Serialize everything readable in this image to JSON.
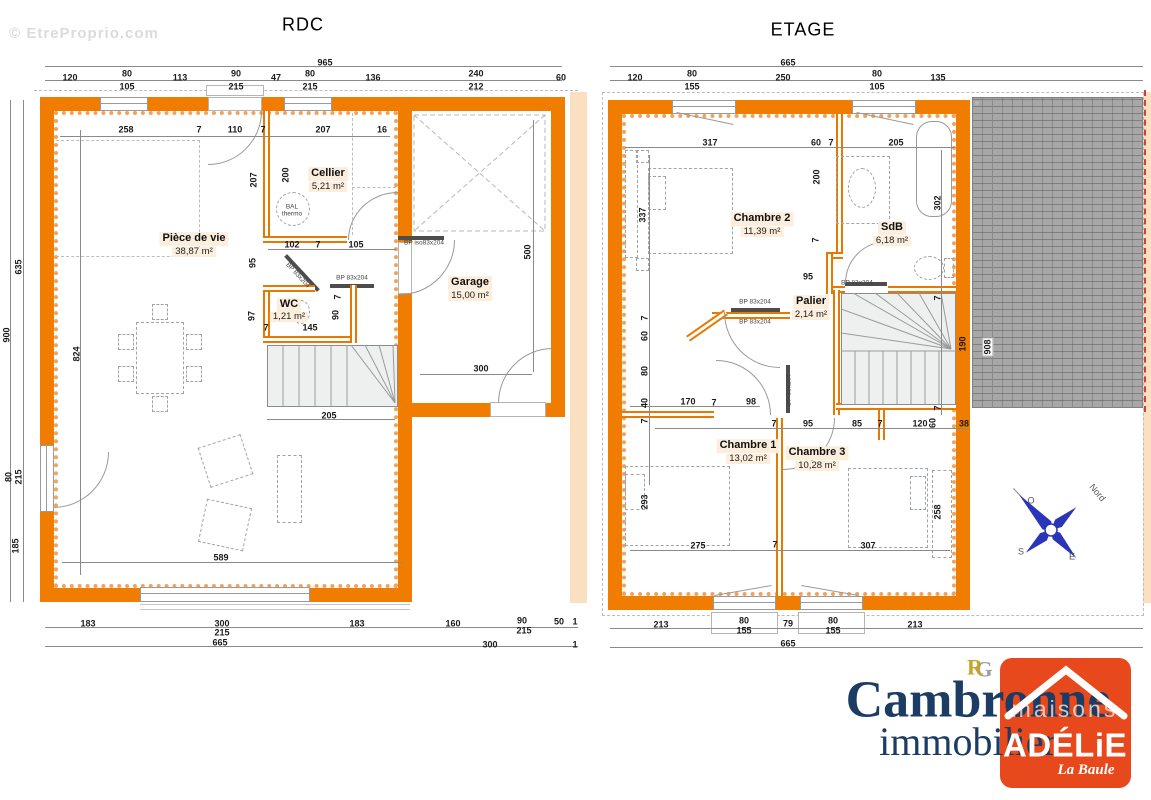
{
  "document": {
    "watermark": "© EtreProprio.com",
    "floors": [
      {
        "name": "RDC",
        "rooms": [
          {
            "name": "Pièce de vie",
            "area": "38,87 m²"
          },
          {
            "name": "Cellier",
            "area": "5,21 m²"
          },
          {
            "name": "WC",
            "area": "1,21 m²"
          },
          {
            "name": "Garage",
            "area": "15,00 m²"
          }
        ]
      },
      {
        "name": "ETAGE",
        "rooms": [
          {
            "name": "Chambre 2",
            "area": "11,39 m²"
          },
          {
            "name": "SdB",
            "area": "6,18 m²"
          },
          {
            "name": "Palier",
            "area": "2,14 m²"
          },
          {
            "name": "Chambre 1",
            "area": "13,02 m²"
          },
          {
            "name": "Chambre 3",
            "area": "10,28 m²"
          }
        ]
      }
    ],
    "compass": {
      "north": "Nord",
      "west": "O",
      "south": "S",
      "east": "E"
    },
    "branding": {
      "monogram_r": "R",
      "monogram_g": "G",
      "agency_line1": "Cambronne",
      "agency_line2": "immobilier",
      "logo_word": "maisons",
      "logo_name": "ADÉLiE",
      "logo_sub": "La Baule"
    },
    "colors": {
      "wall": "#F07C00",
      "insulation": "#F1A35A",
      "roof": "#A7A7A7",
      "logo": "#E8491C",
      "navy": "#1C3C63",
      "gold": "#C9A227"
    }
  },
  "labels": [
    {
      "t": "© EtreProprio.com",
      "x": 84,
      "y": 34,
      "c": "wm",
      "n": "watermark"
    },
    {
      "t": "RDC",
      "x": 303,
      "y": 25,
      "c": "title",
      "n": "rdc-title"
    },
    {
      "t": "ETAGE",
      "x": 803,
      "y": 30,
      "c": "title",
      "n": "etage-title"
    },
    {
      "t": "965",
      "x": 325,
      "y": 63
    },
    {
      "t": "120",
      "x": 70,
      "y": 78
    },
    {
      "t": "80",
      "x": 127,
      "y": 74
    },
    {
      "t": "105",
      "x": 127,
      "y": 87
    },
    {
      "t": "113",
      "x": 180,
      "y": 78
    },
    {
      "t": "90",
      "x": 236,
      "y": 74
    },
    {
      "t": "215",
      "x": 236,
      "y": 87
    },
    {
      "t": "47",
      "x": 276,
      "y": 78
    },
    {
      "t": "80",
      "x": 310,
      "y": 74
    },
    {
      "t": "215",
      "x": 310,
      "y": 87
    },
    {
      "t": "136",
      "x": 373,
      "y": 78
    },
    {
      "t": "240",
      "x": 476,
      "y": 74
    },
    {
      "t": "212",
      "x": 476,
      "y": 87
    },
    {
      "t": "60",
      "x": 561,
      "y": 78
    },
    {
      "t": "900",
      "x": 7,
      "y": 335,
      "r": -90
    },
    {
      "t": "635",
      "x": 19,
      "y": 267,
      "r": -90
    },
    {
      "t": "80",
      "x": 9,
      "y": 477,
      "r": -90
    },
    {
      "t": "215",
      "x": 19,
      "y": 477,
      "r": -90
    },
    {
      "t": "185",
      "x": 16,
      "y": 546,
      "r": -90
    },
    {
      "t": "183",
      "x": 88,
      "y": 624
    },
    {
      "t": "300",
      "x": 222,
      "y": 624
    },
    {
      "t": "215",
      "x": 222,
      "y": 633
    },
    {
      "t": "183",
      "x": 357,
      "y": 624
    },
    {
      "t": "160",
      "x": 453,
      "y": 624
    },
    {
      "t": "90",
      "x": 522,
      "y": 621
    },
    {
      "t": "215",
      "x": 524,
      "y": 631
    },
    {
      "t": "50",
      "x": 559,
      "y": 622
    },
    {
      "t": "1",
      "x": 575,
      "y": 622
    },
    {
      "t": "665",
      "x": 220,
      "y": 643
    },
    {
      "t": "300",
      "x": 490,
      "y": 645
    },
    {
      "t": "1",
      "x": 575,
      "y": 645
    },
    {
      "t": "258",
      "x": 126,
      "y": 130
    },
    {
      "t": "7",
      "x": 199,
      "y": 130
    },
    {
      "t": "110",
      "x": 235,
      "y": 130
    },
    {
      "t": "7",
      "x": 263,
      "y": 130
    },
    {
      "t": "207",
      "x": 323,
      "y": 130
    },
    {
      "t": "16",
      "x": 382,
      "y": 130
    },
    {
      "t": "207",
      "x": 254,
      "y": 180,
      "r": -90
    },
    {
      "t": "200",
      "x": 286,
      "y": 175,
      "r": -90
    },
    {
      "t": "102",
      "x": 292,
      "y": 245
    },
    {
      "t": "7",
      "x": 318,
      "y": 245
    },
    {
      "t": "105",
      "x": 356,
      "y": 245
    },
    {
      "t": "95",
      "x": 253,
      "y": 263,
      "r": -90
    },
    {
      "t": "97",
      "x": 252,
      "y": 316,
      "r": -90
    },
    {
      "t": "7",
      "x": 266,
      "y": 328
    },
    {
      "t": "145",
      "x": 310,
      "y": 328
    },
    {
      "t": "90",
      "x": 336,
      "y": 315,
      "r": -90
    },
    {
      "t": "7",
      "x": 338,
      "y": 297,
      "r": -90
    },
    {
      "t": "500",
      "x": 528,
      "y": 252,
      "r": -90
    },
    {
      "t": "300",
      "x": 481,
      "y": 369
    },
    {
      "t": "205",
      "x": 329,
      "y": 416
    },
    {
      "t": "824",
      "x": 77,
      "y": 354,
      "r": -90
    },
    {
      "t": "589",
      "x": 221,
      "y": 558
    },
    {
      "t": "Pièce de vie",
      "x": 194,
      "y": 239,
      "c": "room",
      "n": "room-piece-de-vie"
    },
    {
      "t": "38,87 m²",
      "x": 194,
      "y": 252,
      "c": "area"
    },
    {
      "t": "Cellier",
      "x": 328,
      "y": 174,
      "c": "room",
      "n": "room-cellier"
    },
    {
      "t": "5,21 m²",
      "x": 328,
      "y": 187,
      "c": "area"
    },
    {
      "t": "WC",
      "x": 289,
      "y": 305,
      "c": "room",
      "n": "room-wc"
    },
    {
      "t": "1,21 m²",
      "x": 289,
      "y": 317,
      "c": "area"
    },
    {
      "t": "Garage",
      "x": 470,
      "y": 283,
      "c": "room",
      "n": "room-garage"
    },
    {
      "t": "15,00 m²",
      "x": 470,
      "y": 296,
      "c": "area"
    },
    {
      "t": "BAL",
      "x": 292,
      "y": 208,
      "c": "tiny"
    },
    {
      "t": "thermo",
      "x": 292,
      "y": 215,
      "c": "tiny"
    },
    {
      "t": "BP iso83x204",
      "x": 424,
      "y": 244,
      "c": "tiny"
    },
    {
      "t": "BP 83x204",
      "x": 352,
      "y": 279,
      "c": "tiny"
    },
    {
      "t": "BP 83x204",
      "x": 297,
      "y": 276,
      "r": 47,
      "c": "tiny"
    },
    {
      "t": "665",
      "x": 788,
      "y": 63
    },
    {
      "t": "120",
      "x": 635,
      "y": 78
    },
    {
      "t": "80",
      "x": 692,
      "y": 74
    },
    {
      "t": "155",
      "x": 692,
      "y": 87
    },
    {
      "t": "250",
      "x": 783,
      "y": 78
    },
    {
      "t": "80",
      "x": 877,
      "y": 74
    },
    {
      "t": "105",
      "x": 877,
      "y": 87
    },
    {
      "t": "135",
      "x": 938,
      "y": 78
    },
    {
      "t": "213",
      "x": 661,
      "y": 625
    },
    {
      "t": "80",
      "x": 744,
      "y": 621
    },
    {
      "t": "155",
      "x": 744,
      "y": 631
    },
    {
      "t": "79",
      "x": 788,
      "y": 624
    },
    {
      "t": "80",
      "x": 833,
      "y": 621
    },
    {
      "t": "155",
      "x": 833,
      "y": 631
    },
    {
      "t": "213",
      "x": 915,
      "y": 625
    },
    {
      "t": "665",
      "x": 788,
      "y": 644
    },
    {
      "t": "317",
      "x": 710,
      "y": 143
    },
    {
      "t": "60",
      "x": 816,
      "y": 143
    },
    {
      "t": "7",
      "x": 831,
      "y": 143
    },
    {
      "t": "205",
      "x": 896,
      "y": 143
    },
    {
      "t": "337",
      "x": 643,
      "y": 215,
      "r": -90
    },
    {
      "t": "200",
      "x": 817,
      "y": 177,
      "r": -90
    },
    {
      "t": "302",
      "x": 938,
      "y": 203,
      "r": -90
    },
    {
      "t": "7",
      "x": 816,
      "y": 240,
      "r": -90
    },
    {
      "t": "95",
      "x": 808,
      "y": 277
    },
    {
      "t": "7",
      "x": 938,
      "y": 298,
      "r": -90
    },
    {
      "t": "190",
      "x": 963,
      "y": 344,
      "r": -90
    },
    {
      "t": "7",
      "x": 938,
      "y": 408,
      "r": -90
    },
    {
      "t": "7",
      "x": 645,
      "y": 318,
      "r": -90
    },
    {
      "t": "60",
      "x": 645,
      "y": 336,
      "r": -90
    },
    {
      "t": "80",
      "x": 645,
      "y": 371,
      "r": -90
    },
    {
      "t": "40",
      "x": 645,
      "y": 403,
      "r": -90
    },
    {
      "t": "7",
      "x": 645,
      "y": 421,
      "r": -90
    },
    {
      "t": "293",
      "x": 645,
      "y": 502,
      "r": -90
    },
    {
      "t": "170",
      "x": 688,
      "y": 402
    },
    {
      "t": "7",
      "x": 714,
      "y": 403
    },
    {
      "t": "98",
      "x": 751,
      "y": 402
    },
    {
      "t": "7",
      "x": 774,
      "y": 424
    },
    {
      "t": "95",
      "x": 808,
      "y": 424
    },
    {
      "t": "85",
      "x": 857,
      "y": 424
    },
    {
      "t": "7",
      "x": 880,
      "y": 424
    },
    {
      "t": "120",
      "x": 920,
      "y": 424
    },
    {
      "t": "60",
      "x": 933,
      "y": 423,
      "r": -90
    },
    {
      "t": "38",
      "x": 964,
      "y": 424
    },
    {
      "t": "275",
      "x": 698,
      "y": 546
    },
    {
      "t": "7",
      "x": 775,
      "y": 545
    },
    {
      "t": "307",
      "x": 868,
      "y": 546
    },
    {
      "t": "258",
      "x": 938,
      "y": 512,
      "r": -90
    },
    {
      "t": "908",
      "x": 988,
      "y": 347,
      "r": -90,
      "c": "chipdim"
    },
    {
      "t": "Chambre 2",
      "x": 762,
      "y": 219,
      "c": "room",
      "n": "room-chambre-2"
    },
    {
      "t": "11,39 m²",
      "x": 762,
      "y": 232,
      "c": "area"
    },
    {
      "t": "SdB",
      "x": 892,
      "y": 228,
      "c": "room",
      "n": "room-sdb"
    },
    {
      "t": "6,18 m²",
      "x": 892,
      "y": 241,
      "c": "area"
    },
    {
      "t": "Palier",
      "x": 811,
      "y": 302,
      "c": "room",
      "n": "room-palier"
    },
    {
      "t": "2,14 m²",
      "x": 811,
      "y": 315,
      "c": "area"
    },
    {
      "t": "Chambre 1",
      "x": 748,
      "y": 446,
      "c": "room",
      "n": "room-chambre-1"
    },
    {
      "t": "13,02 m²",
      "x": 748,
      "y": 459,
      "c": "area"
    },
    {
      "t": "Chambre 3",
      "x": 817,
      "y": 453,
      "c": "room",
      "n": "room-chambre-3"
    },
    {
      "t": "10,28 m²",
      "x": 817,
      "y": 466,
      "c": "area"
    },
    {
      "t": "BP 83x204",
      "x": 857,
      "y": 284,
      "c": "tiny"
    },
    {
      "t": "BP 83x204",
      "x": 755,
      "y": 303,
      "c": "tiny"
    },
    {
      "t": "BP 83x204",
      "x": 755,
      "y": 323,
      "c": "tiny"
    },
    {
      "t": "BP 83x204",
      "x": 790,
      "y": 390,
      "r": -90,
      "c": "tiny"
    },
    {
      "t": "Nord",
      "x": 1097,
      "y": 493,
      "r": 50,
      "c": "north",
      "n": "compass-north-label"
    },
    {
      "t": "O",
      "x": 1031,
      "y": 501,
      "c": "north"
    },
    {
      "t": "S",
      "x": 1021,
      "y": 552,
      "c": "north"
    },
    {
      "t": "E",
      "x": 1072,
      "y": 557,
      "c": "north"
    },
    {
      "t": "G",
      "x": 984,
      "y": 669,
      "c": "mg",
      "n": "monogram-g"
    },
    {
      "t": "R",
      "x": 975,
      "y": 667,
      "c": "mr",
      "n": "monogram-r"
    },
    {
      "t": "Cambronne",
      "x": 978,
      "y": 701,
      "c": "brand1",
      "n": "agency-name"
    },
    {
      "t": "immobilier",
      "x": 968,
      "y": 742,
      "c": "brand2",
      "n": "agency-subtitle"
    },
    {
      "t": "maisons",
      "x": 1065,
      "y": 709,
      "c": "lgm",
      "n": "logo-maisons"
    },
    {
      "t": "ADÉLiE",
      "x": 1065,
      "y": 746,
      "c": "lgn",
      "n": "logo-adelie"
    },
    {
      "t": "La Baule",
      "x": 1086,
      "y": 771,
      "c": "lgs",
      "n": "logo-la-baule"
    }
  ]
}
